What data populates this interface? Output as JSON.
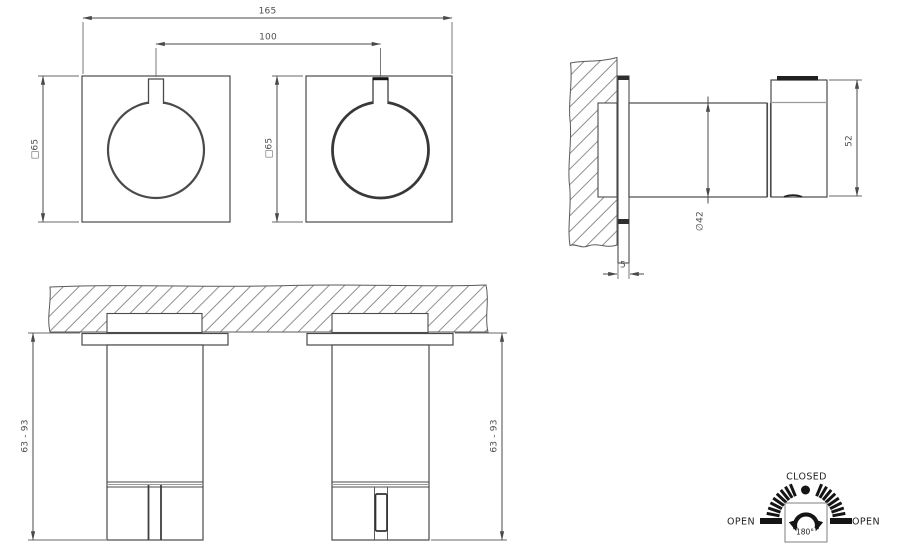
{
  "views": {
    "front": {
      "dim_overall_width": "165",
      "dim_center_distance": "100",
      "dim_plate_size_left": "□65",
      "dim_plate_size_right": "□65"
    },
    "side": {
      "dim_diameter": "∅42",
      "dim_handle_height": "52",
      "dim_plate_thickness": "5"
    },
    "section": {
      "dim_depth_range_left": "63 - 93",
      "dim_depth_range_right": "63 - 93"
    },
    "rotation": {
      "closed": "CLOSED",
      "open_left": "OPEN",
      "open_right": "OPEN",
      "angle": "180°"
    }
  },
  "colors": {
    "line": "#4a4a4a",
    "hatch": "#8f8f8f",
    "dim_text": "#4d4d4d",
    "dial_black": "#151515",
    "background": "#ffffff"
  }
}
